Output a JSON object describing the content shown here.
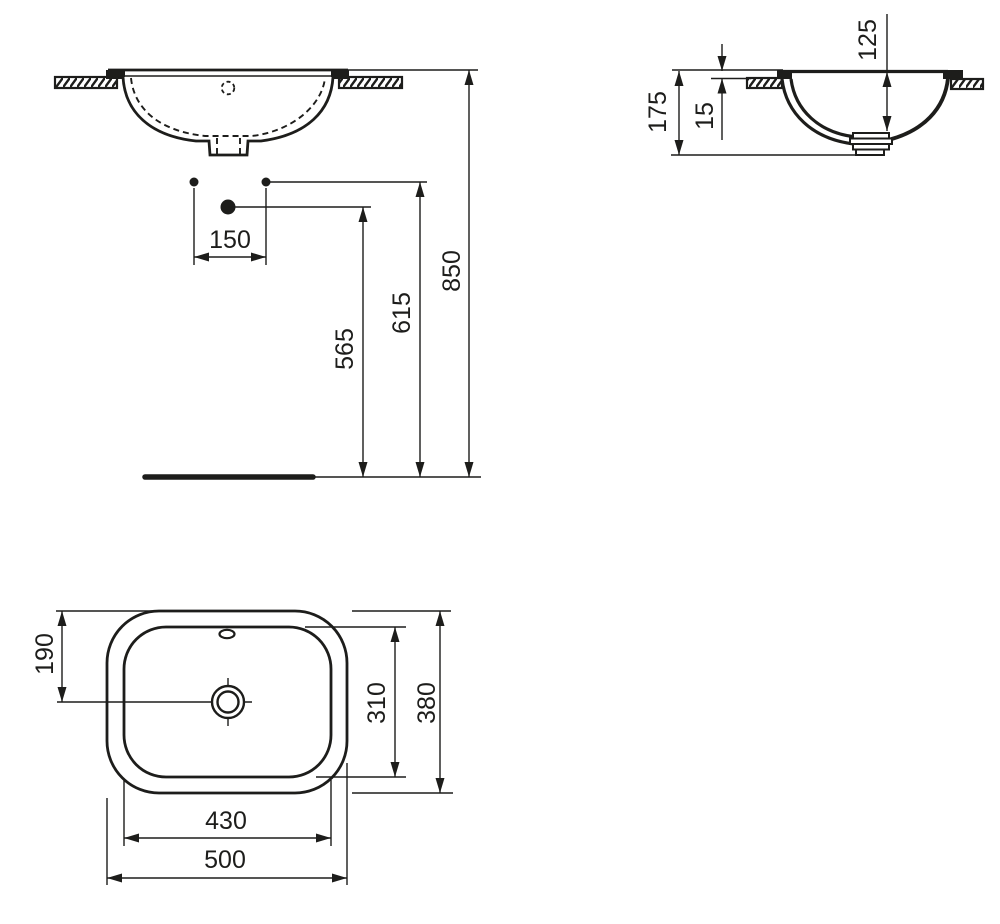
{
  "colors": {
    "line": "#1d1d1b",
    "background": "#ffffff"
  },
  "front_view": {
    "dims": {
      "d150": "150",
      "d565": "565",
      "d615": "615",
      "d850": "850"
    }
  },
  "side_view": {
    "dims": {
      "d125": "125",
      "d175": "175",
      "d15": "15"
    }
  },
  "plan_view": {
    "dims": {
      "d190": "190",
      "d310": "310",
      "d380": "380",
      "d430": "430",
      "d500": "500"
    }
  }
}
